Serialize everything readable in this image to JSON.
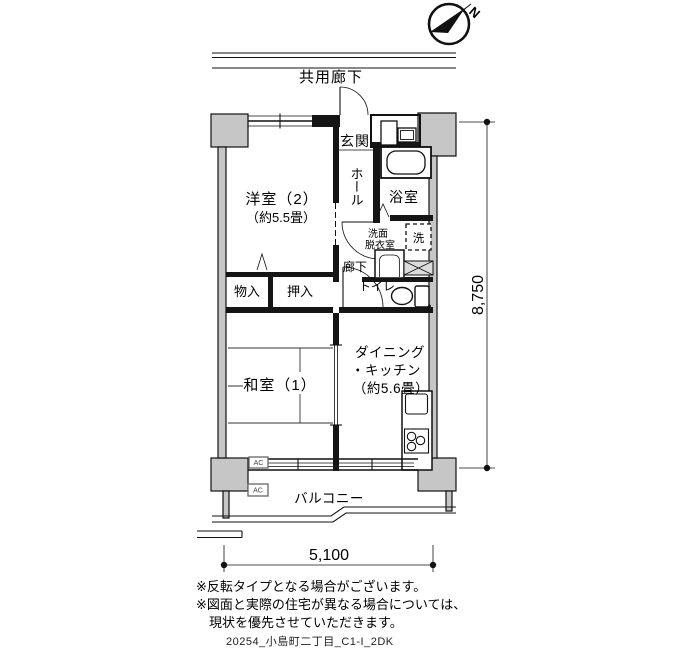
{
  "compass": {
    "label": "N"
  },
  "labels": {
    "common_corridor": "共用廊下",
    "genkan": "玄関",
    "hall": "ホール",
    "bathroom": "浴室",
    "washroom_line1": "洗面",
    "washroom_line2": "脱衣室",
    "laundry": "洗",
    "corridor": "廊下",
    "toilet": "トイレ",
    "storage": "物入",
    "closet": "押入",
    "western_room": "洋室（2）",
    "western_room_size": "（約5.5畳）",
    "dining_line1": "ダイニング",
    "dining_line2": "・キッチン",
    "dining_line3": "（約5.6畳）",
    "japanese_room": "和室（1）",
    "balcony": "バルコニー",
    "ac": "AC"
  },
  "dimensions": {
    "horizontal": "5,100",
    "vertical": "8,750"
  },
  "notes": [
    "※反転タイプとなる場合がございます。",
    "※図面と実際の住宅が異なる場合については、",
    "現状を優先させていただきます。"
  ],
  "footer_code": "20254_小島町二丁目_C1-I_2DK"
}
